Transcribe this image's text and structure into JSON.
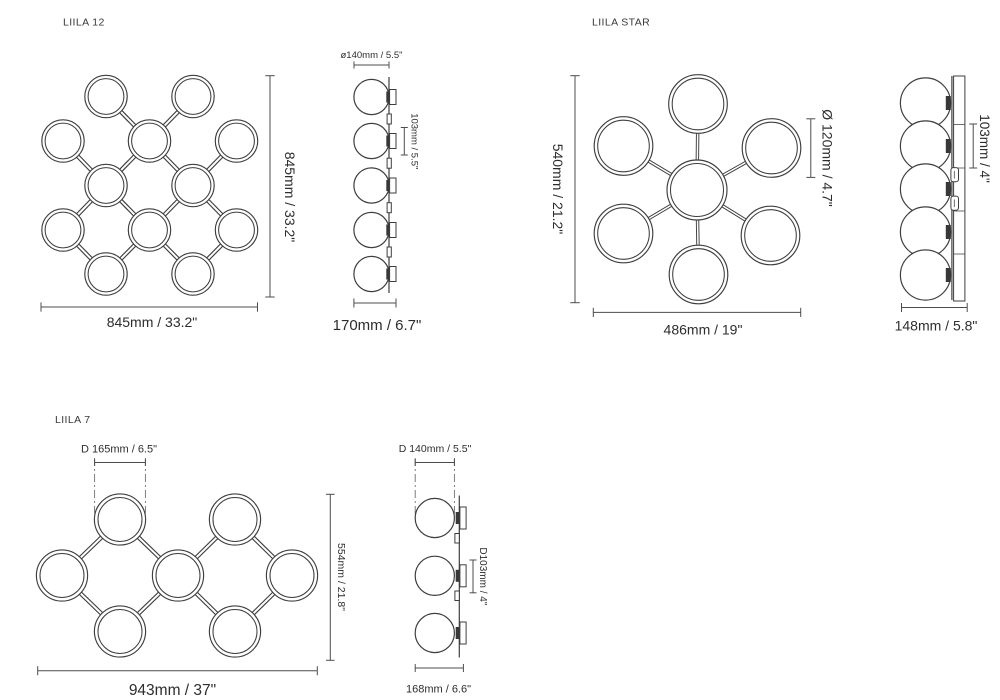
{
  "colors": {
    "background": "#ffffff",
    "linework": "#3e3e3e",
    "dimension_lines": "#4c4c4c",
    "text": "#2d2d2d"
  },
  "panels": {
    "liila12": {
      "title": "LIILA 12",
      "front": {
        "height_label": "845mm / 33.2\"",
        "width_label": "845mm / 33.2\""
      },
      "side": {
        "sphere_diameter_label": "ø140mm / 5.5\"",
        "spacing_label": "103mm / 5.5\"",
        "depth_label": "170mm / 6.7\""
      }
    },
    "liilaStar": {
      "title": "LIILA STAR",
      "front": {
        "height_label": "540mm / 21.2\"",
        "ring_diameter_label": "Ø 120mm / 4.7\"",
        "width_label": "486mm / 19\""
      },
      "side": {
        "spacing_label": "103mm / 4\"",
        "depth_label": "148mm / 5.8\""
      }
    },
    "liila7": {
      "title": "LIILA 7",
      "front": {
        "ring_diameter_label": "D 165mm / 6.5\"",
        "height_label": "554mm / 21.8\"",
        "width_label": "943mm / 37\""
      },
      "side": {
        "sphere_diameter_label": "D 140mm / 5.5\"",
        "inner_diameter_label": "D103mm / 4\"",
        "depth_label": "168mm / 6.6\""
      }
    }
  }
}
